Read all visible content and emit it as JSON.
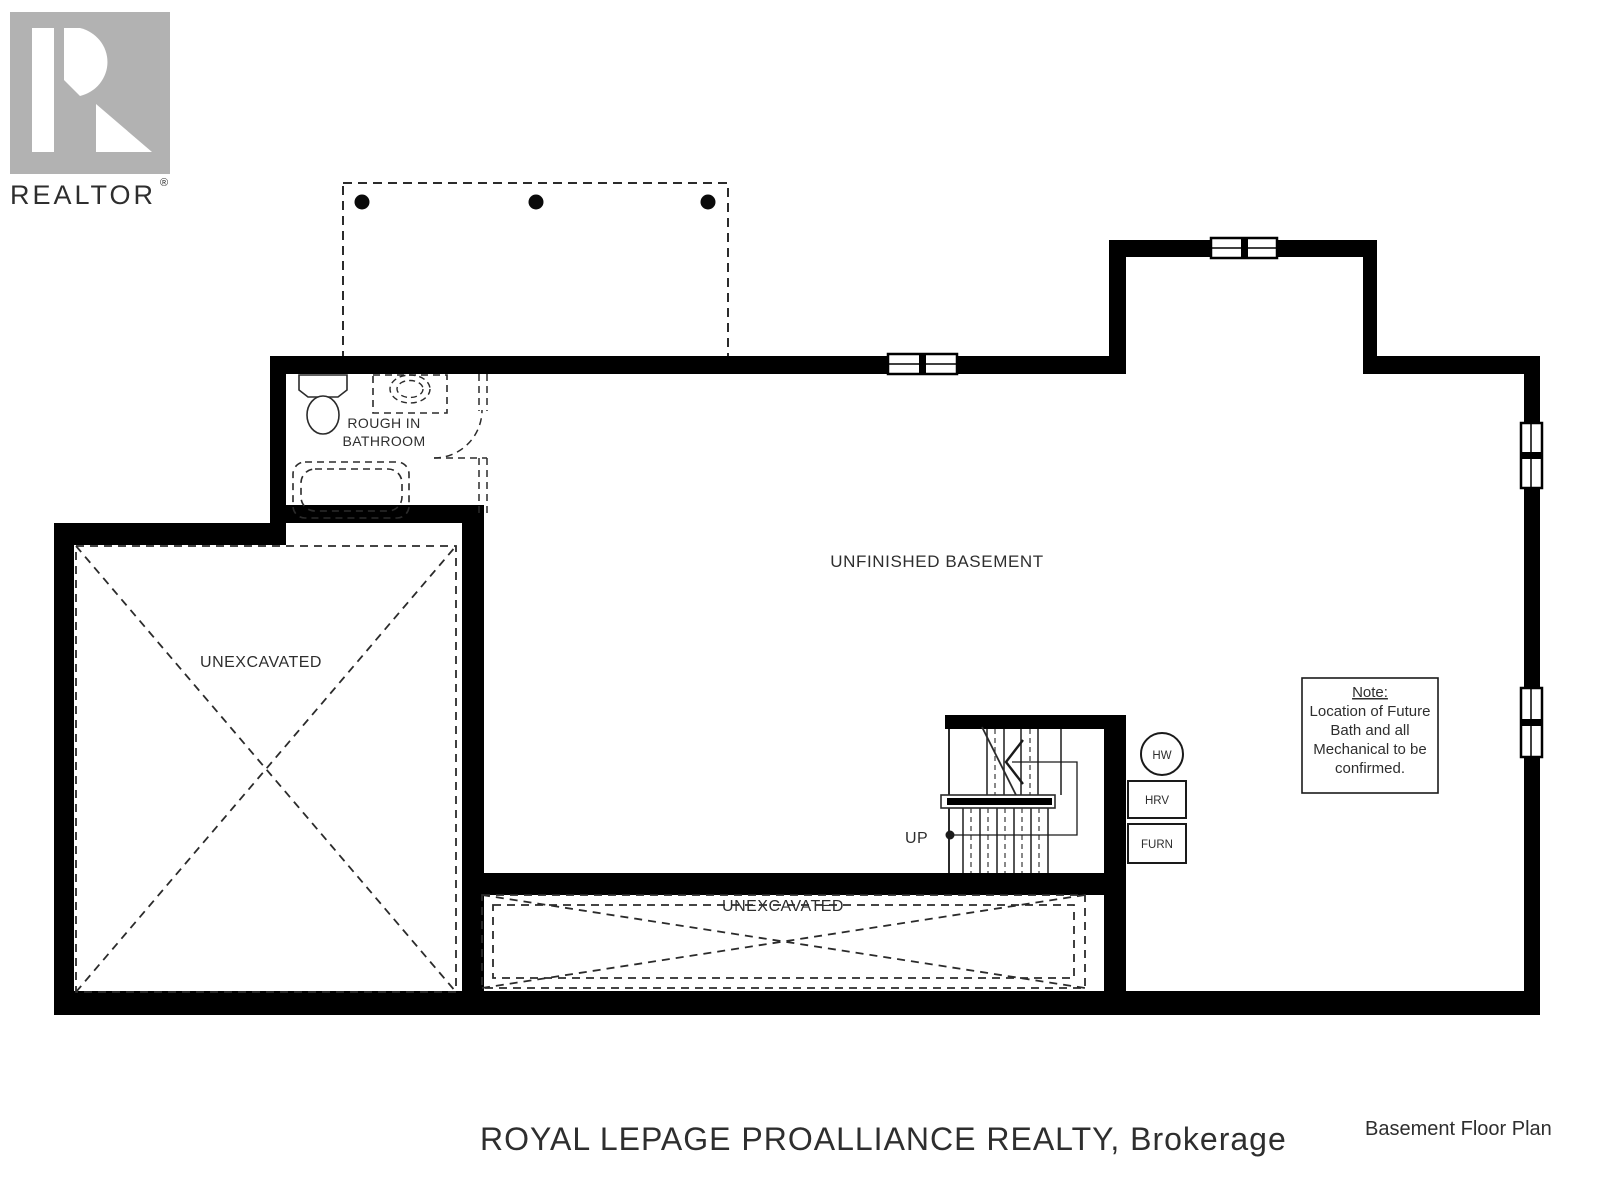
{
  "logo": {
    "symbol": "realtor-r-block",
    "label": "REALTOR",
    "registered": "®",
    "color": "#b2b2b2"
  },
  "plan": {
    "rooms": {
      "bathroom_line1": "ROUGH IN",
      "bathroom_line2": "BATHROOM",
      "basement": "UNFINISHED BASEMENT",
      "unexcavated_left": "UNEXCAVATED",
      "unexcavated_bottom": "UNEXCAVATED",
      "stairs_direction": "UP"
    },
    "equipment": {
      "hot_water": "HW",
      "hrv": "HRV",
      "furnace": "FURN"
    },
    "note": {
      "title": "Note:",
      "lines": [
        "Location of Future",
        "Bath and all",
        "Mechanical to be",
        "confirmed."
      ]
    },
    "fixtures": [
      "toilet",
      "sink",
      "bathtub",
      "door-swing",
      "stairs",
      "deck-posts"
    ],
    "colors": {
      "wall": "#000000",
      "line": "#2b2b2b",
      "dash": "#3a3a3a"
    }
  },
  "watermark": {
    "text": "ROYAL LEPAGE PROALLIANCE REALTY, Brokerage",
    "color": "#e1e1e1"
  },
  "footer": {
    "title": "Basement Floor Plan",
    "color": "#3b455e"
  }
}
